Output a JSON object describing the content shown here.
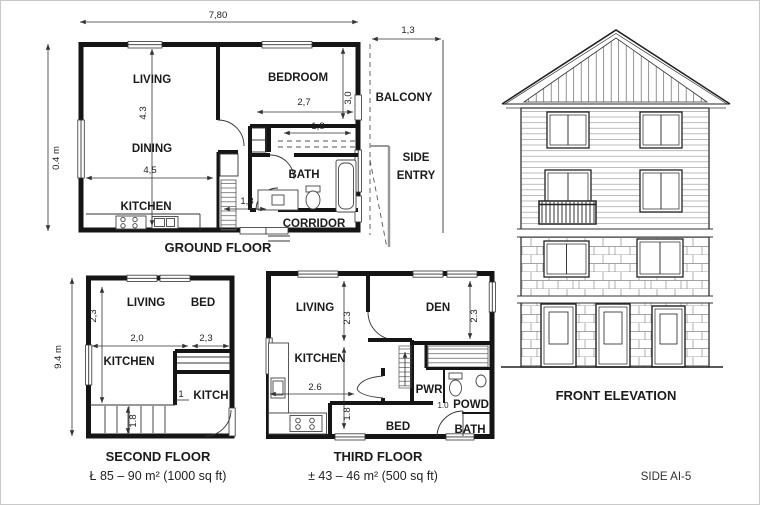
{
  "sheet": {
    "side_label": "SIDE AI-5",
    "line_color": "#1b1b1b",
    "background": "#ffffff"
  },
  "ground_floor": {
    "title": "GROUND FLOOR",
    "rooms": {
      "living": "LIVING",
      "bedroom": "BEDROOM",
      "dining": "DINING",
      "kitchen": "KITCHEN",
      "bath": "BATH",
      "corridor": "CORRIDOR",
      "balcony": "BALCONY",
      "side_entry_line1": "SIDE",
      "side_entry_line2": "ENTRY"
    },
    "dims": {
      "overall_width": "7,80",
      "overall_height": "0.4 m",
      "living_height": "4.3",
      "dining_width": "4,5",
      "bedroom_width": "2,7",
      "bedroom_height": "3,0",
      "closet_width": "1,8",
      "hall_width": "1,3",
      "balcony_width": "1,3"
    }
  },
  "second_floor": {
    "title": "SECOND FLOOR",
    "area_note": "Ł 85 – 90 m² (1000 sq ft)",
    "rooms": {
      "living": "LIVING",
      "bed": "BED",
      "kitchen": "KITCHEN",
      "kitch": "KITCH"
    },
    "dims": {
      "overall_height": "9.4 m",
      "living_height": "2,3",
      "living_width": "2,0",
      "bed_width": "2,3",
      "kitch_width": "1",
      "stair_width": "1.8"
    }
  },
  "third_floor": {
    "title": "THIRD FLOOR",
    "area_note": "± 43 – 46 m² (500 sq ft)",
    "rooms": {
      "living": "LIVING",
      "den": "DEN",
      "kitchen": "KITCHEN",
      "pwr": "PWR",
      "powd": "POWD",
      "bed": "BED",
      "bath": "BATH"
    },
    "dims": {
      "living_height": "2.3",
      "den_height": "2.3",
      "kitchen_width": "2.6",
      "stair_height": "1.8",
      "powd_width": "1.0"
    }
  },
  "elevation": {
    "title": "FRONT ELEVATION"
  }
}
